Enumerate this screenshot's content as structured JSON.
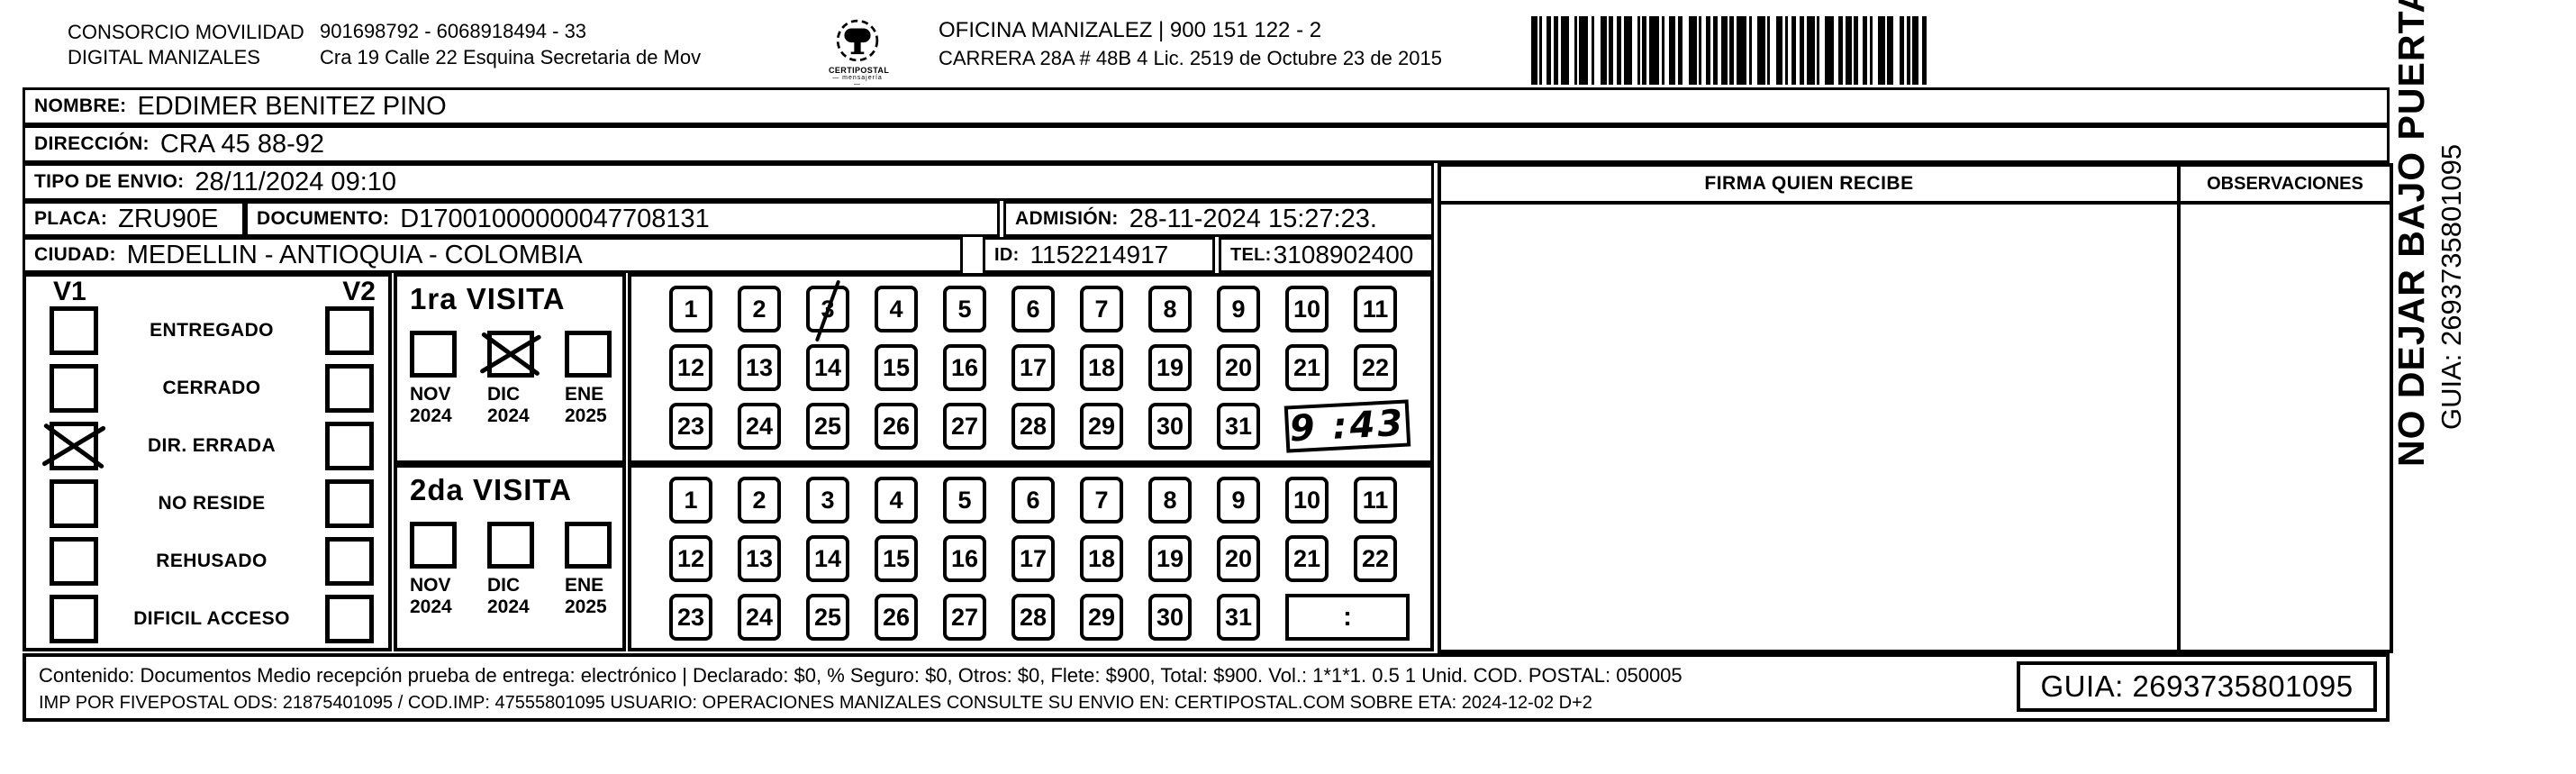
{
  "header": {
    "company_line1": "CONSORCIO MOVILIDAD",
    "company_line2": "DIGITAL MANIZALES",
    "registration_line1": "901698792 - 6068918494 - 33",
    "registration_line2": "Cra 19 Calle 22 Esquina Secretaria de Mov",
    "logo_caption": "CERTIPOSTAL",
    "logo_tagline": "— mensajería —",
    "office_line1": "OFICINA MANIZALEZ | 900 151 122 - 2",
    "office_line2": "CARRERA 28A #  48B 4 Lic. 2519 de Octubre 23 de 2015"
  },
  "shipment": {
    "nombre_label": "NOMBRE:",
    "nombre": "EDDIMER BENITEZ PINO",
    "direccion_label": "DIRECCIÓN:",
    "direccion": "CRA 45 88-92",
    "tipo_envio_label": "TIPO DE ENVIO:",
    "tipo_envio": "28/11/2024 09:10",
    "placa_label": "PLACA:",
    "placa": "ZRU90E",
    "documento_label": "DOCUMENTO:",
    "documento": "D17001000000047708131",
    "admision_label": "ADMISIÓN:",
    "admision": "28-11-2024 15:27:23.",
    "ciudad_label": "CIUDAD:",
    "ciudad": "MEDELLIN - ANTIOQUIA - COLOMBIA",
    "id_label": "ID:",
    "id_value": "1152214917",
    "tel_label": "TEL:",
    "tel": "3108902400"
  },
  "visits": {
    "v1_label": "V1",
    "v2_label": "V2",
    "status_options": [
      "ENTREGADO",
      "CERRADO",
      "DIR. ERRADA",
      "NO RESIDE",
      "REHUSADO",
      "DIFICIL ACCESO"
    ],
    "v1_checked_index": 2,
    "v2_checked_index": -1,
    "day_rows": [
      [
        1,
        2,
        3,
        4,
        5,
        6,
        7,
        8,
        9,
        10,
        11
      ],
      [
        12,
        13,
        14,
        15,
        16,
        17,
        18,
        19,
        20,
        21,
        22
      ],
      [
        23,
        24,
        25,
        26,
        27,
        28,
        29,
        30,
        31
      ]
    ],
    "visit1": {
      "title": "1ra VISITA",
      "months": [
        {
          "month": "NOV",
          "year": "2024"
        },
        {
          "month": "DIC",
          "year": "2024"
        },
        {
          "month": "ENE",
          "year": "2025"
        }
      ],
      "checked_month_index": 1,
      "marked_day": 3,
      "time_value": "9 :43",
      "time_handwritten": true
    },
    "visit2": {
      "title": "2da VISITA",
      "months": [
        {
          "month": "NOV",
          "year": "2024"
        },
        {
          "month": "DIC",
          "year": "2024"
        },
        {
          "month": "ENE",
          "year": "2025"
        }
      ],
      "checked_month_index": -1,
      "marked_day": null,
      "time_value": ":",
      "time_handwritten": false
    }
  },
  "signature": {
    "firma_header": "FIRMA QUIEN RECIBE",
    "observaciones_header": "OBSERVACIONES"
  },
  "footer": {
    "line1": "Contenido: Documentos Medio recepción prueba de entrega: electrónico | Declarado: $0, % Seguro: $0, Otros: $0, Flete: $900, Total: $900. Vol.: 1*1*1. 0.5  1 Unid. COD. POSTAL: 050005",
    "line2": "IMP POR FIVEPOSTAL ODS: 21875401095 / COD.IMP: 47555801095 USUARIO: OPERACIONES MANIZALES CONSULTE SU ENVIO EN: CERTIPOSTAL.COM SOBRE ETA: 2024-12-02 D+2",
    "guia": "GUIA: 2693735801095"
  },
  "side_note": {
    "warning": "NO DEJAR BAJO PUERTA",
    "guia": "GUIA: 2693735801095"
  }
}
